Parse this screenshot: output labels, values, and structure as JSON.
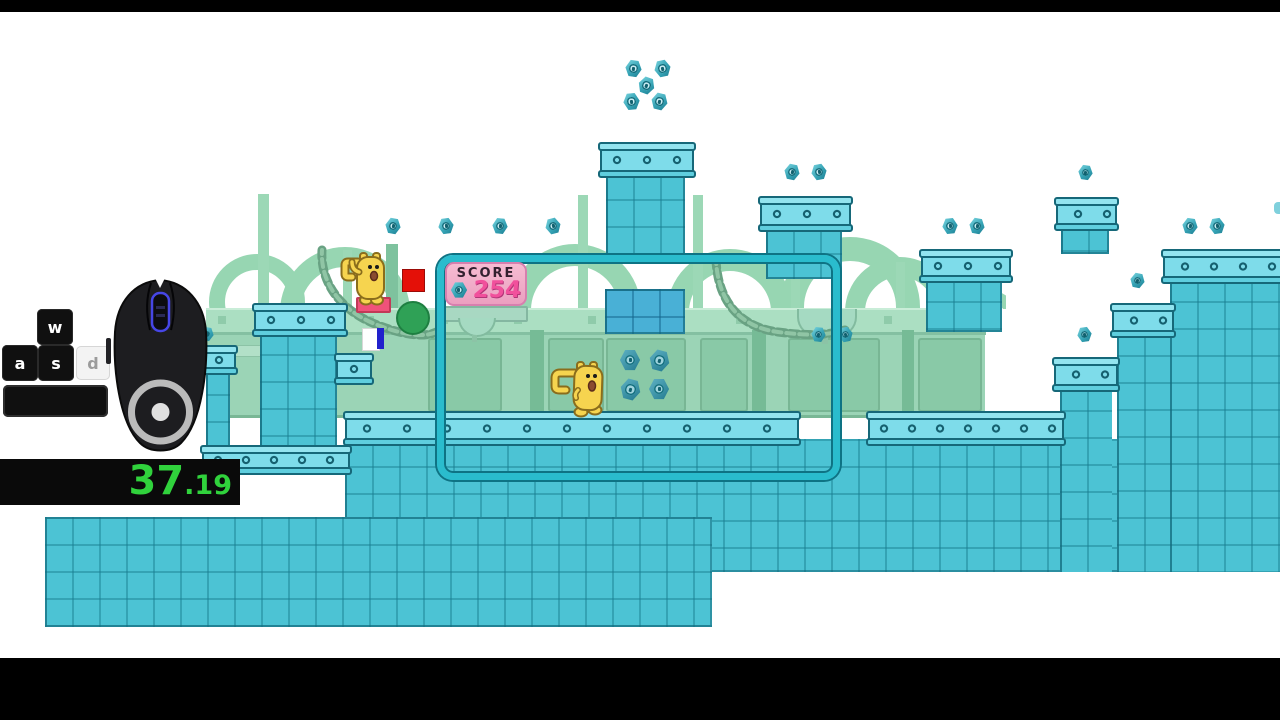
{
  "app": {
    "type": "game-speedrun-stream"
  },
  "hud": {
    "score": {
      "label": "SCORE",
      "value": "254",
      "icon": "hex-bolt-icon",
      "panel_bg": "#f2abc8",
      "value_color": "#f1509c"
    },
    "timer": {
      "seconds": "37",
      "fraction": ".19",
      "color": "#30d23c",
      "bg": "#0a0a0a"
    },
    "keys": {
      "w": {
        "label": "w",
        "pressed": true
      },
      "a": {
        "label": "a",
        "pressed": true
      },
      "s": {
        "label": "s",
        "pressed": true
      },
      "d": {
        "label": "d",
        "pressed": false
      },
      "space": {
        "label": "",
        "pressed": true
      }
    },
    "mouse": {
      "icon": "gaming-mouse-icon",
      "wheel_glow": "#4646e6"
    }
  },
  "scene": {
    "colors": {
      "platform_teal": "#4cc3d4",
      "platform_cap": "#7edcea",
      "platform_border": "#16687a",
      "background_green": "#9bd4b6",
      "chain_green": "#69a283",
      "ball_green": "#2fa156",
      "red_button": "#e41008",
      "pink_pad": "#f0527a",
      "door_blue": "#2121cc",
      "viewport_outline": "#2abccd",
      "character_yellow": "#f6d44f",
      "score_pink": "#f1509c"
    },
    "characters": [
      {
        "name": "wubbzy-standing",
        "x": 336,
        "y": 238
      },
      {
        "name": "wubbzy-walking",
        "x": 548,
        "y": 348
      }
    ],
    "bolts": [
      {
        "x": 633,
        "y": 56,
        "s": 17,
        "r": 8
      },
      {
        "x": 662,
        "y": 56,
        "s": 17,
        "r": -12
      },
      {
        "x": 646,
        "y": 73,
        "s": 17,
        "r": 20
      },
      {
        "x": 631,
        "y": 89,
        "s": 17,
        "r": -6
      },
      {
        "x": 659,
        "y": 89,
        "s": 17,
        "r": 14
      },
      {
        "x": 393,
        "y": 214,
        "s": 16,
        "r": 10
      },
      {
        "x": 446,
        "y": 214,
        "s": 16,
        "r": -8
      },
      {
        "x": 500,
        "y": 214,
        "s": 16,
        "r": 6
      },
      {
        "x": 553,
        "y": 214,
        "s": 16,
        "r": -14
      },
      {
        "x": 792,
        "y": 160,
        "s": 16,
        "r": 12
      },
      {
        "x": 819,
        "y": 160,
        "s": 16,
        "r": -10
      },
      {
        "x": 1085,
        "y": 160,
        "s": 15,
        "r": 8
      },
      {
        "x": 950,
        "y": 214,
        "s": 16,
        "r": -6
      },
      {
        "x": 977,
        "y": 214,
        "s": 16,
        "r": 10
      },
      {
        "x": 1190,
        "y": 214,
        "s": 16,
        "r": 9
      },
      {
        "x": 1217,
        "y": 214,
        "s": 16,
        "r": -9
      },
      {
        "x": 1137,
        "y": 268,
        "s": 15,
        "r": 12
      },
      {
        "x": 1084,
        "y": 322,
        "s": 15,
        "r": -8
      },
      {
        "x": 818,
        "y": 322,
        "s": 15,
        "r": 6
      },
      {
        "x": 845,
        "y": 322,
        "s": 15,
        "r": -12
      },
      {
        "x": 207,
        "y": 322,
        "s": 14,
        "r": 10
      },
      {
        "x": 630,
        "y": 348,
        "s": 21,
        "r": 0,
        "v": 1
      },
      {
        "x": 659,
        "y": 348,
        "s": 21,
        "r": 15,
        "v": 1
      },
      {
        "x": 630,
        "y": 377,
        "s": 21,
        "r": 15,
        "v": 1
      },
      {
        "x": 659,
        "y": 377,
        "s": 21,
        "r": 0,
        "v": 1
      }
    ]
  }
}
